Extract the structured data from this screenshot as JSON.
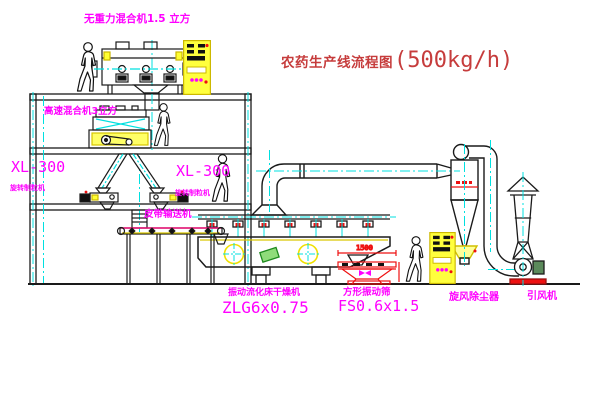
{
  "diagram": {
    "title": {
      "text": "农药生产线流程图",
      "capacity": "(500kg/h)"
    },
    "labels": {
      "gravity_free_mixer": "无重力混合机1.5 立方",
      "high_speed_mixer": "高速混合机3立方",
      "granulator_left_model": "XL-300",
      "granulator_left_name": "旋转制粒机",
      "granulator_center_model": "XL-300",
      "granulator_center_name": "旋转制粒机",
      "belt_conveyor": "皮带输送机",
      "fluid_bed_dryer_name": "振动流化床干燥机",
      "fluid_bed_dryer_model": "ZLG6x0.75",
      "square_screen_name": "方形振动筛",
      "square_screen_model": "FS0.6x1.5",
      "cyclone": "旋风除尘器",
      "induced_draft_fan": "引风机"
    },
    "dimensions": {
      "screen_length": "1500"
    },
    "colors": {
      "label_magenta": "#ff00ff",
      "title_red": "#c63c3c",
      "equipment_yellow": "#ffff33",
      "centerline_cyan": "#00e0e0",
      "outline_black": "#1a1a1a",
      "accent_red": "#ee2222",
      "accent_green": "#2e9e2e"
    }
  }
}
